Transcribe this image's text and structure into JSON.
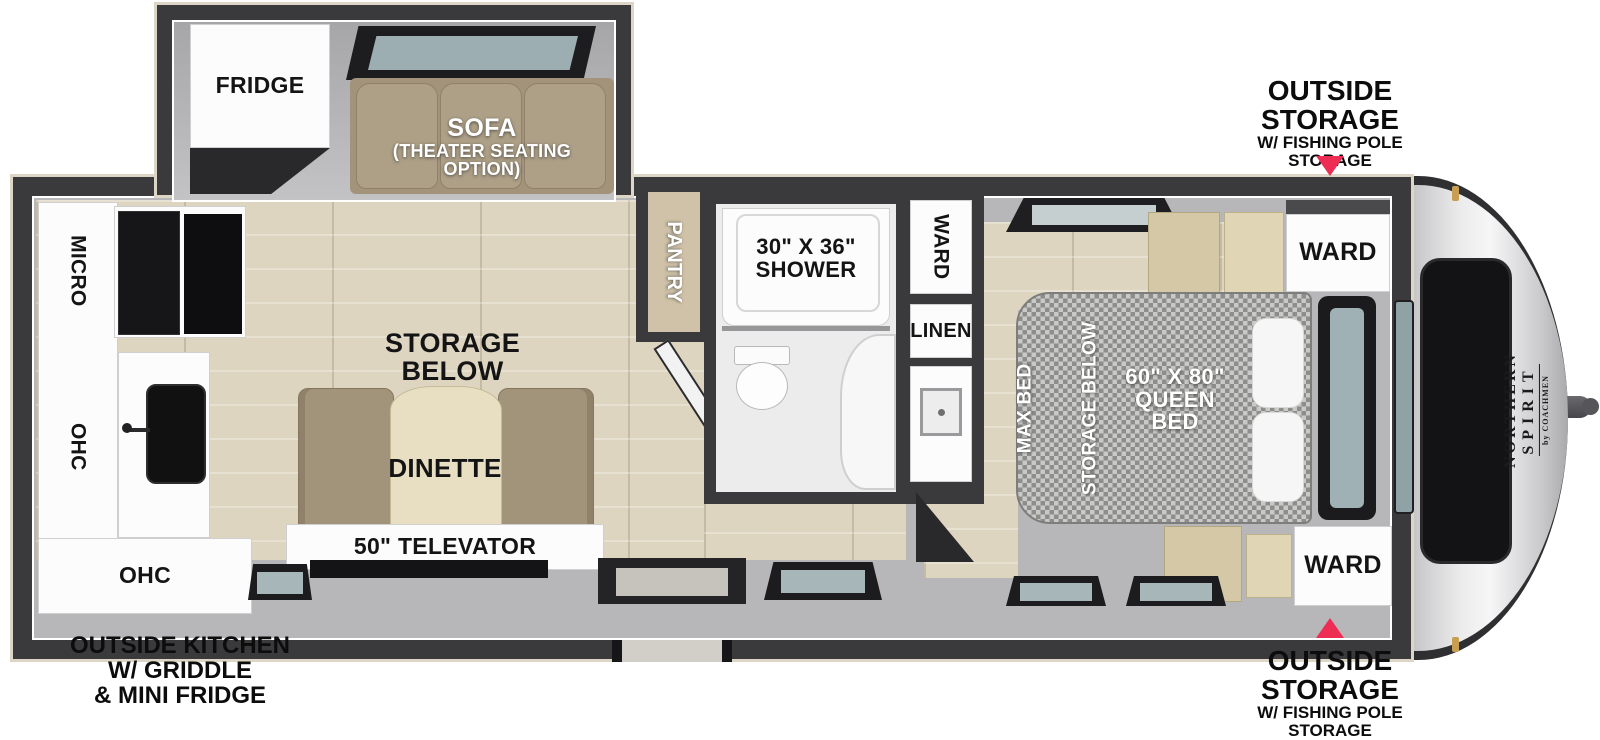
{
  "plan": {
    "brand": {
      "line1": "NORTHERN",
      "line2": "SPIRIT",
      "byline": "by COACHMEN"
    },
    "callouts": {
      "storage_top": {
        "big1": "OUTSIDE",
        "big2": "STORAGE",
        "small1": "W/ FISHING POLE",
        "small2": "STORAGE"
      },
      "storage_bottom": {
        "big1": "OUTSIDE",
        "big2": "STORAGE",
        "small1": "W/ FISHING POLE",
        "small2": "STORAGE"
      },
      "outside_kitchen": {
        "line1": "OUTSIDE KITCHEN",
        "line2": "W/ GRIDDLE",
        "line3": "& MINI FRIDGE"
      }
    },
    "slideout": {
      "fridge": "FRIDGE",
      "sofa": "SOFA",
      "sofa_option_1": "(THEATER SEATING",
      "sofa_option_2": "OPTION)"
    },
    "kitchen": {
      "micro": "MICRO",
      "ohc_wall": "OHC",
      "ohc_base": "OHC"
    },
    "living": {
      "storage_1": "STORAGE",
      "storage_2": "BELOW",
      "dinette": "DINETTE",
      "tv": "50\" TELEVATOR",
      "pantry": "PANTRY"
    },
    "bath": {
      "shower_size": "30\" X 36\"",
      "shower": "SHOWER",
      "linen": "LINEN"
    },
    "bedroom": {
      "ward_entry": "WARD",
      "ward_front_top": "WARD",
      "ward_front_bottom": "WARD",
      "maxbed_1": "MAX BED",
      "maxbed_2": "STORAGE BELOW",
      "bed_size": "60\" X 80\"",
      "bed_line2": "QUEEN",
      "bed_line3": "BED"
    }
  },
  "colors": {
    "wall": "#3a3a3c",
    "outer_trim": "#ddd6c6",
    "interior_gray": "#b7b7b9",
    "floor_wood": "#ded5c1",
    "furniture_tan": "#a2947b",
    "cabinet_tan": "#d5c8a6",
    "appliance_black": "#161618",
    "window_glass": "#a7b6b9",
    "bed_gray": "#9a9a98",
    "arrow_accent": "#ee2d55",
    "label_black": "#141414",
    "label_white": "#ffffff"
  }
}
